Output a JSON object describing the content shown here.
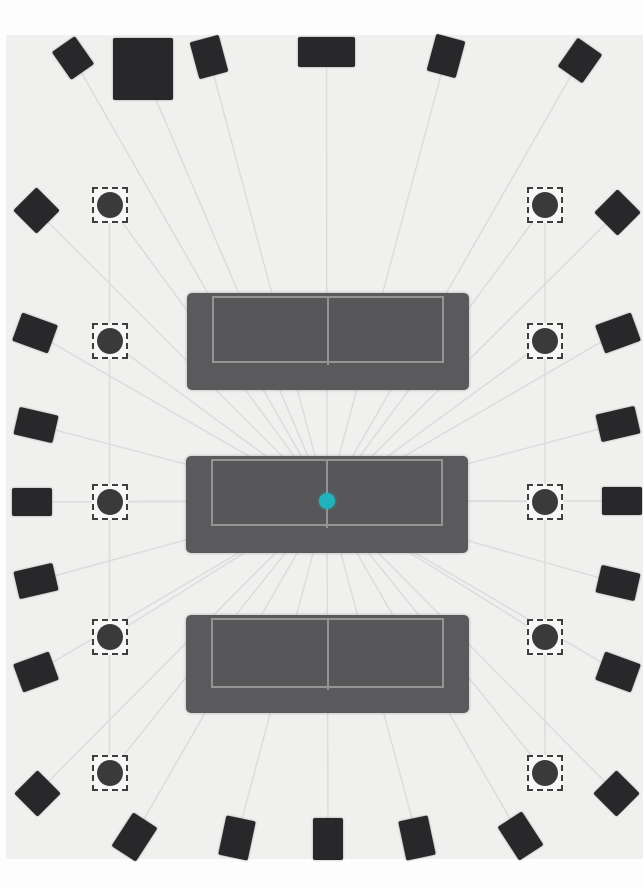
{
  "canvas": {
    "width": 643,
    "height": 888
  },
  "room": {
    "x": 6,
    "y": 35,
    "width": 637,
    "height": 824,
    "fill": "#f0f0ef",
    "outer_fill": "#fdfdfd"
  },
  "colors": {
    "speaker_fill": "#28282a",
    "sofa_body": "#5a5a5c",
    "sofa_seat": "#575759",
    "sofa_line": "#949494",
    "ceiling_circle_fill": "#3a3a3c",
    "ceiling_box_border": "#3e3e3e",
    "ceiling_box_bg": "#f7f7f6",
    "projection_line": "#dcdcdc",
    "listening_dot": "#22b2bc"
  },
  "listening_position": {
    "x": 327,
    "y": 501,
    "diameter": 16,
    "color": "#22b2bc"
  },
  "sofas": [
    {
      "name": "sofa-front",
      "x": 187,
      "y": 293,
      "w": 282,
      "h": 97,
      "arm": 25,
      "seat_top": 3,
      "seat_h": 67
    },
    {
      "name": "sofa-middle",
      "x": 186,
      "y": 456,
      "w": 282,
      "h": 97,
      "arm": 25,
      "seat_top": 3,
      "seat_h": 67
    },
    {
      "name": "sofa-rear",
      "x": 186,
      "y": 615,
      "w": 283,
      "h": 98,
      "arm": 25,
      "seat_top": 3,
      "seat_h": 70
    }
  ],
  "wall_speakers": [
    {
      "name": "front-wide-left-speaker",
      "x": 73,
      "y": 58,
      "w": 28,
      "h": 34,
      "rot": -35
    },
    {
      "name": "subwoofer",
      "x": 143,
      "y": 69,
      "w": 60,
      "h": 62,
      "rot": 0
    },
    {
      "name": "front-left-speaker",
      "x": 209,
      "y": 57,
      "w": 30,
      "h": 38,
      "rot": -15
    },
    {
      "name": "center-channel-speaker",
      "x": 326.5,
      "y": 52,
      "w": 57,
      "h": 30,
      "rot": 0
    },
    {
      "name": "front-right-speaker",
      "x": 446,
      "y": 56,
      "w": 30,
      "h": 38,
      "rot": 15
    },
    {
      "name": "front-wide-right-speaker",
      "x": 580,
      "y": 60,
      "w": 30,
      "h": 35,
      "rot": 35
    },
    {
      "name": "surround-left-1-speaker",
      "x": 36,
      "y": 210,
      "w": 33,
      "h": 33,
      "rot": 45
    },
    {
      "name": "surround-left-2-speaker",
      "x": 35,
      "y": 333,
      "w": 38,
      "h": 30,
      "rot": 20
    },
    {
      "name": "surround-left-3-speaker",
      "x": 36,
      "y": 425,
      "w": 40,
      "h": 28,
      "rot": 13
    },
    {
      "name": "surround-left-4-speaker",
      "x": 31.5,
      "y": 502,
      "w": 40,
      "h": 28,
      "rot": 0
    },
    {
      "name": "surround-left-5-speaker",
      "x": 36,
      "y": 581,
      "w": 40,
      "h": 28,
      "rot": -13
    },
    {
      "name": "surround-left-6-speaker",
      "x": 36,
      "y": 672,
      "w": 38,
      "h": 30,
      "rot": -20
    },
    {
      "name": "surround-left-7-speaker",
      "x": 37,
      "y": 793,
      "w": 33,
      "h": 33,
      "rot": 45
    },
    {
      "name": "surround-right-1-speaker",
      "x": 617.5,
      "y": 212,
      "w": 33,
      "h": 33,
      "rot": 45
    },
    {
      "name": "surround-right-2-speaker",
      "x": 617.5,
      "y": 332.5,
      "w": 38,
      "h": 30,
      "rot": -20
    },
    {
      "name": "surround-right-3-speaker",
      "x": 618,
      "y": 424,
      "w": 40,
      "h": 28,
      "rot": -13
    },
    {
      "name": "surround-right-4-speaker",
      "x": 622,
      "y": 501,
      "w": 40,
      "h": 28,
      "rot": 0
    },
    {
      "name": "surround-right-5-speaker",
      "x": 618,
      "y": 583,
      "w": 40,
      "h": 28,
      "rot": 13
    },
    {
      "name": "surround-right-6-speaker",
      "x": 618,
      "y": 672,
      "w": 38,
      "h": 30,
      "rot": 20
    },
    {
      "name": "surround-right-7-speaker",
      "x": 616,
      "y": 793,
      "w": 33,
      "h": 33,
      "rot": 45
    },
    {
      "name": "rear-left-outer-speaker",
      "x": 134,
      "y": 836.5,
      "w": 29,
      "h": 40,
      "rot": 33
    },
    {
      "name": "rear-left-speaker",
      "x": 237,
      "y": 837.5,
      "w": 30,
      "h": 40,
      "rot": 12
    },
    {
      "name": "rear-center-speaker",
      "x": 328,
      "y": 839,
      "w": 30,
      "h": 42,
      "rot": 0
    },
    {
      "name": "rear-right-speaker",
      "x": 417,
      "y": 837.5,
      "w": 30,
      "h": 40,
      "rot": -12
    },
    {
      "name": "rear-right-outer-speaker",
      "x": 520,
      "y": 836,
      "w": 29,
      "h": 40,
      "rot": -33
    }
  ],
  "ceiling_speakers": [
    {
      "name": "height-left-1-speaker",
      "x": 109.5,
      "y": 205
    },
    {
      "name": "height-left-2-speaker",
      "x": 109.5,
      "y": 341
    },
    {
      "name": "height-left-3-speaker",
      "x": 109.5,
      "y": 501.5
    },
    {
      "name": "height-left-4-speaker",
      "x": 110,
      "y": 637
    },
    {
      "name": "height-left-5-speaker",
      "x": 110,
      "y": 772.5
    },
    {
      "name": "height-right-1-speaker",
      "x": 545,
      "y": 205
    },
    {
      "name": "height-right-2-speaker",
      "x": 545,
      "y": 341
    },
    {
      "name": "height-right-3-speaker",
      "x": 545,
      "y": 501.5
    },
    {
      "name": "height-right-4-speaker",
      "x": 545,
      "y": 637
    },
    {
      "name": "height-right-5-speaker",
      "x": 545,
      "y": 772.5
    }
  ],
  "ceiling_columns": [
    {
      "x": 109.5,
      "y1": 205,
      "y2": 772.5
    },
    {
      "x": 545,
      "y1": 205,
      "y2": 772.5
    }
  ]
}
